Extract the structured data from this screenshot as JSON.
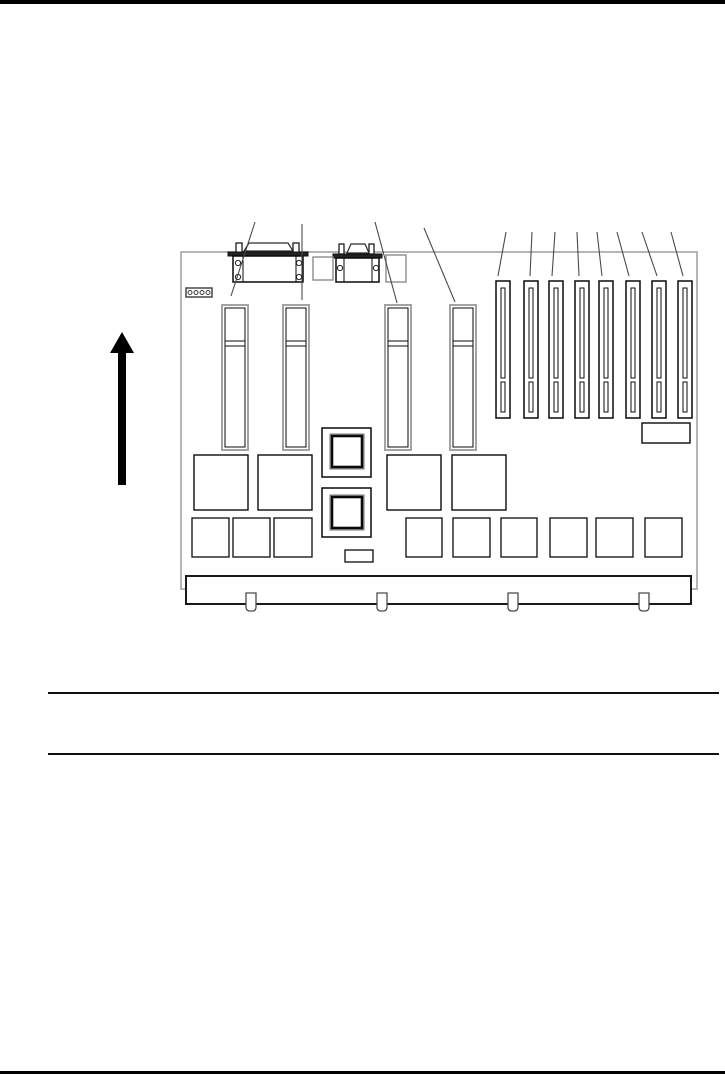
{
  "page": {
    "width": 725,
    "height": 1075,
    "background": "#ffffff",
    "top_bar": {
      "y": 0,
      "height": 4,
      "color": "#000000"
    },
    "bottom_bar": {
      "y": 1071,
      "height": 3,
      "color": "#000000"
    },
    "note_rules": {
      "x1": 48,
      "x2": 719,
      "y_top": 692,
      "y_bottom": 753,
      "thickness": 2,
      "color": "#111111"
    }
  },
  "diagram": {
    "name": "system-board-rear-view",
    "colors": {
      "board_outline": "#a3a3a3",
      "component_line": "#0a0a0a",
      "soft_line": "#8c8c8c",
      "leader_line": "#4a4a4a",
      "fill": "#ffffff"
    },
    "orientation_arrow": {
      "cx": 122,
      "tip_y": 332,
      "head_base_y": 353,
      "head_half_width": 12,
      "shaft_half_width": 4,
      "tail_y": 485
    },
    "board_outline": {
      "x": 181,
      "y": 252,
      "width": 516,
      "height": 337
    },
    "jumper_block": {
      "x": 186,
      "y": 288,
      "width": 26,
      "height": 9,
      "pin_count": 4
    },
    "connectors": [
      {
        "name": "parallel-port-connector",
        "posts": [
          [
            236,
            243,
            6,
            10
          ],
          [
            293,
            243,
            6,
            10
          ]
        ],
        "shell": [
          [
            244,
            251
          ],
          [
            249,
            243
          ],
          [
            288,
            243
          ],
          [
            293,
            251
          ]
        ],
        "flange": [
          228,
          252,
          80,
          4
        ],
        "body": [
          233,
          256,
          70,
          26
        ],
        "column_lines": [
          243,
          296
        ],
        "screws": [
          [
            238,
            263
          ],
          [
            238,
            277
          ],
          [
            299,
            263
          ],
          [
            299,
            277
          ]
        ],
        "screw_radius": 2.6
      },
      {
        "name": "serial-port-connector",
        "posts": [
          [
            339,
            244,
            5,
            10
          ],
          [
            369,
            244,
            5,
            10
          ]
        ],
        "shell": [
          [
            347,
            253
          ],
          [
            351,
            244
          ],
          [
            365,
            244
          ],
          [
            369,
            253
          ]
        ],
        "flange": [
          333,
          254,
          49,
          4
        ],
        "body": [
          336,
          258,
          43,
          24
        ],
        "column_lines": [
          344,
          372
        ],
        "screws": [
          [
            340,
            268
          ],
          [
            376,
            268
          ]
        ],
        "screw_radius": 2.6
      }
    ],
    "connector_pads": [
      [
        313,
        257,
        20,
        23
      ],
      [
        386,
        255,
        20,
        27
      ]
    ],
    "memory_slots": {
      "xs": [
        222,
        283,
        385,
        450
      ],
      "y": 305,
      "width": 26,
      "height": 145,
      "inner_inset": 3,
      "divider_ys": [
        341,
        346
      ]
    },
    "expansion_slots": {
      "xs": [
        496,
        524,
        549,
        575,
        599,
        626,
        652,
        678
      ],
      "y": 281,
      "width": 14,
      "height": 137,
      "inner": {
        "x_offset": 5,
        "width": 4,
        "upper": [
          288,
          378
        ],
        "lower": [
          382,
          412
        ]
      }
    },
    "slot_label_rect": [
      642,
      423,
      48,
      20
    ],
    "large_chips": [
      [
        194,
        455,
        54,
        55
      ],
      [
        258,
        455,
        54,
        55
      ],
      [
        387,
        455,
        54,
        55
      ],
      [
        452,
        455,
        54,
        55
      ]
    ],
    "processor_modules": [
      {
        "outer": [
          322,
          428,
          49,
          49
        ],
        "inner": [
          332,
          436,
          30,
          31
        ]
      },
      {
        "outer": [
          322,
          488,
          49,
          49
        ],
        "inner": [
          332,
          497,
          30,
          31
        ]
      }
    ],
    "small_chips": [
      [
        192,
        518,
        37,
        39
      ],
      [
        233,
        518,
        37,
        39
      ],
      [
        274,
        518,
        38,
        39
      ],
      [
        406,
        518,
        36,
        39
      ],
      [
        453,
        518,
        37,
        39
      ],
      [
        501,
        518,
        36,
        39
      ],
      [
        550,
        518,
        37,
        39
      ],
      [
        596,
        518,
        37,
        39
      ],
      [
        645,
        518,
        37,
        39
      ]
    ],
    "tiny_chip": [
      345,
      550,
      28,
      12
    ],
    "edge_bar": {
      "x": 186,
      "y": 576,
      "width": 505,
      "height": 28
    },
    "mounting_tabs": {
      "centers": [
        251,
        382,
        513,
        644
      ],
      "half_width": 5,
      "top_y": 593,
      "bottom_y": 611
    },
    "leader_lines": [
      [
        255,
        222,
        231,
        296
      ],
      [
        302,
        224,
        302,
        300
      ],
      [
        375,
        222,
        397,
        303
      ],
      [
        424,
        228,
        455,
        302
      ],
      [
        506,
        232,
        498,
        276
      ],
      [
        532,
        232,
        530,
        276
      ],
      [
        555,
        232,
        552,
        276
      ],
      [
        577,
        232,
        579,
        276
      ],
      [
        597,
        232,
        602,
        276
      ],
      [
        617,
        232,
        629,
        276
      ],
      [
        642,
        232,
        657,
        276
      ],
      [
        671,
        232,
        683,
        276
      ]
    ]
  }
}
